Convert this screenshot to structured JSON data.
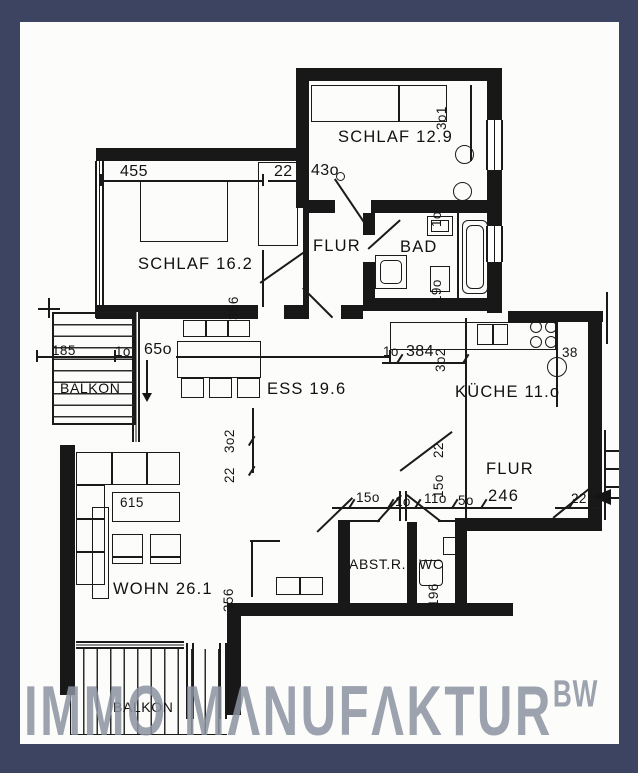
{
  "watermark": {
    "text": "IMMO MΛNUFΛKTUR",
    "suffix": "BW"
  },
  "colors": {
    "frame": "#3d4462",
    "paper": "#fcfcfa",
    "ink": "#1a1a1a",
    "watermark_gray": "#8c93a1"
  },
  "rooms": {
    "schlaf_top": "SCHLAF 12.9",
    "schlaf_left": "SCHLAF 16.2",
    "flur_upper": "FLUR",
    "bad": "BAD",
    "balkon_left": "BALKON",
    "ess": "ESS 19.6",
    "kueche": "KÜCHE 11.o",
    "flur_lower": "FLUR",
    "flur_lower_area": "246",
    "abstellraum": "ABST.R.",
    "wc": "WC",
    "wohn": "WOHN 26.1",
    "balkon_bottom": "BALKON"
  },
  "dims": {
    "d455": "455",
    "d22_schlaf": "22",
    "d430": "43o",
    "d301": "3o1",
    "d10_bad": "1o",
    "d190": "19o",
    "d356_schlaf": "356",
    "d185": "185",
    "d10_balkon": "1o",
    "d650": "65o",
    "d384": "384",
    "d10_kueche": "1o",
    "d302_kueche": "3o2",
    "d38": "38",
    "d302_mid": "3o2",
    "d22_mid": "22",
    "d22_flur": "22",
    "d150_flur": "15o",
    "d150_abst": "15o",
    "d10_abst": "1o",
    "d110_wc": "11o",
    "d50_wc": "5o",
    "d22_entry": "22",
    "d615": "615",
    "d196": "196",
    "d356_wohn": "356"
  }
}
